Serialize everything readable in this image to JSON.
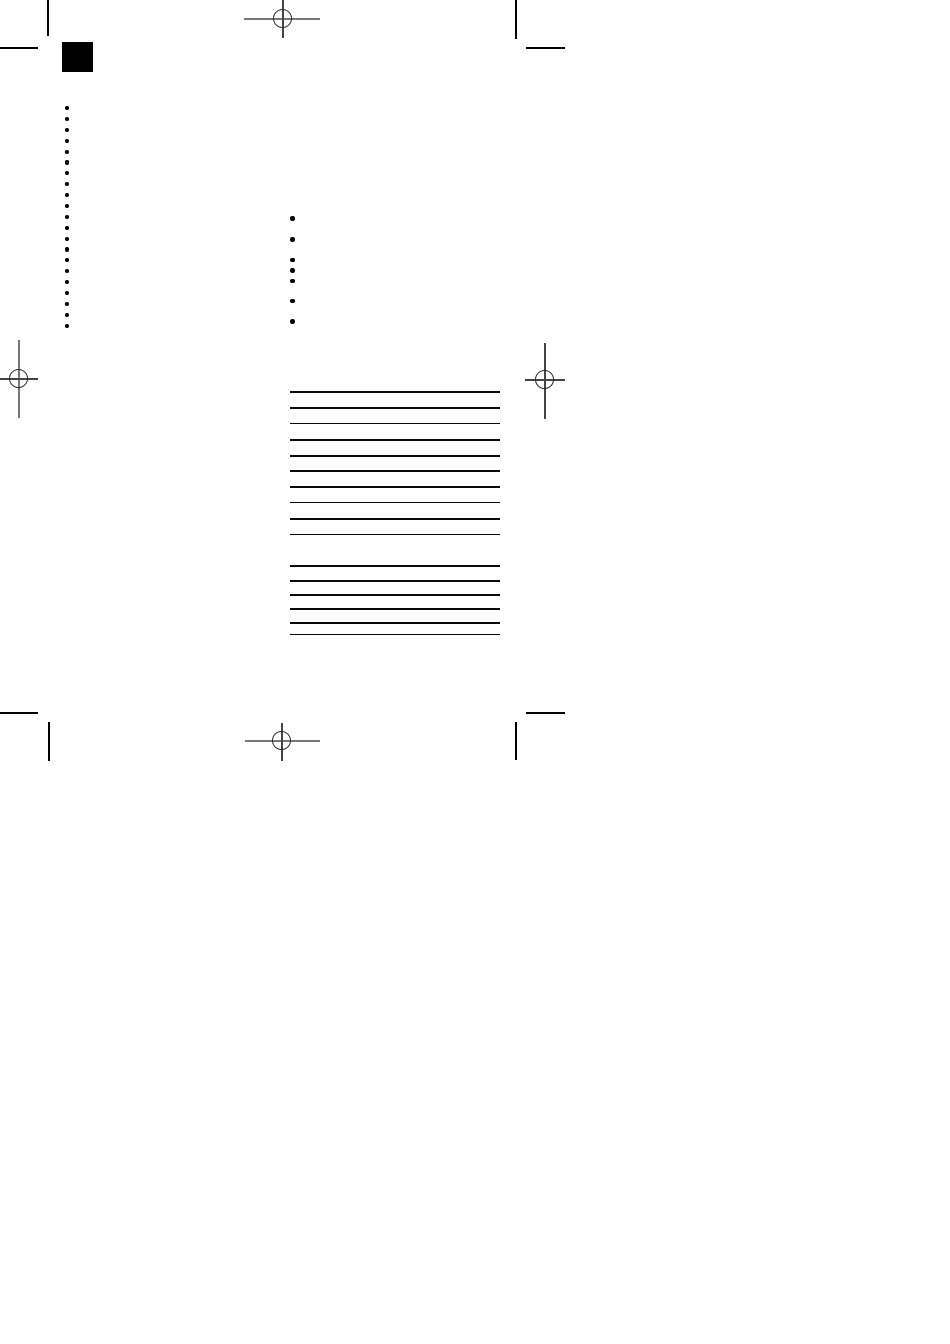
{
  "document": {
    "kind": "scanned-print-proof-page",
    "background": "#ffffff",
    "visible_text": ""
  },
  "colors": {
    "ink": "#000000",
    "rule_line": "#0a0a0a",
    "trim_mark": "#000000",
    "registration_line": "#777777",
    "registration_circle": "#2b2b2b"
  },
  "ink_square": {
    "width": 31,
    "height": 30
  },
  "left_bullet_column": {
    "count": 21
  },
  "bullet_list": {
    "count": 7,
    "tops": [
      216,
      237,
      257.7,
      268.4,
      278.7,
      298.7,
      319.4
    ]
  },
  "ruled_lines": {
    "count": 16,
    "tops": [
      391,
      407,
      422.5,
      439,
      454.8,
      470,
      485.8,
      501.5,
      518,
      533.5,
      565.3,
      579.8,
      594.2,
      608.4,
      622.4,
      633.5
    ]
  },
  "registration_marks": [
    {
      "name": "top-center"
    },
    {
      "name": "left-middle"
    },
    {
      "name": "right-middle"
    },
    {
      "name": "bottom-center"
    }
  ],
  "trim_marks": [
    {
      "name": "top-left-vertical"
    },
    {
      "name": "top-left-horizontal"
    },
    {
      "name": "top-right-vertical"
    },
    {
      "name": "top-right-horizontal"
    },
    {
      "name": "bottom-left-vertical"
    },
    {
      "name": "bottom-left-horizontal"
    },
    {
      "name": "bottom-right-vertical"
    },
    {
      "name": "bottom-right-horizontal"
    }
  ]
}
